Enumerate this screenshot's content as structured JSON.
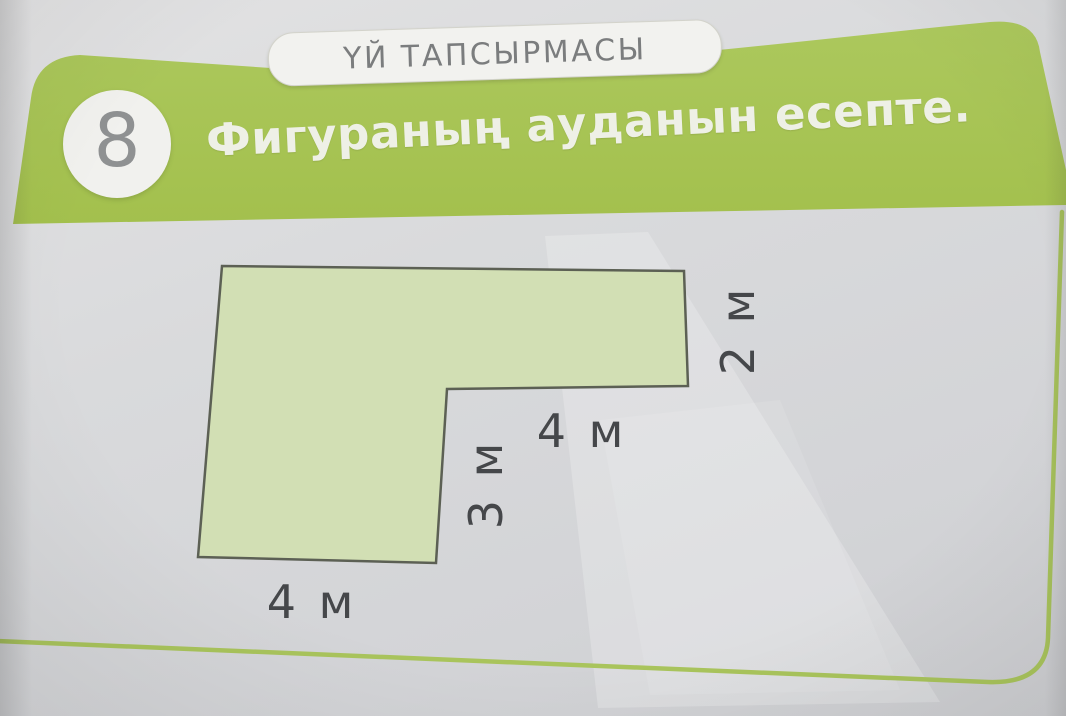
{
  "header": {
    "badge": "ҮЙ ТАПСЫРМАСЫ",
    "task_number": "8",
    "title": "Фигураның ауданын есепте."
  },
  "figure": {
    "description": "L-shaped composite figure for area calculation",
    "unit": "м",
    "labels": {
      "right_side": "2 м",
      "inner_horizontal": "4 м",
      "inner_vertical": "3 м",
      "bottom_side": "4 м"
    },
    "dimensions_m": {
      "right_side": 2,
      "inner_horizontal": 4,
      "inner_vertical": 3,
      "bottom_side": 4
    },
    "fill_color": "#d2dfb4",
    "outline_color": "#5c6054"
  },
  "colors": {
    "header_green": "#a7c455",
    "card_border_green": "#a9c45c",
    "page_background": "#d9dadc",
    "badge_text": "#7b7d7e",
    "number_text": "#8f9192",
    "title_text": "#eef0e6",
    "dimension_text": "#45474a"
  }
}
